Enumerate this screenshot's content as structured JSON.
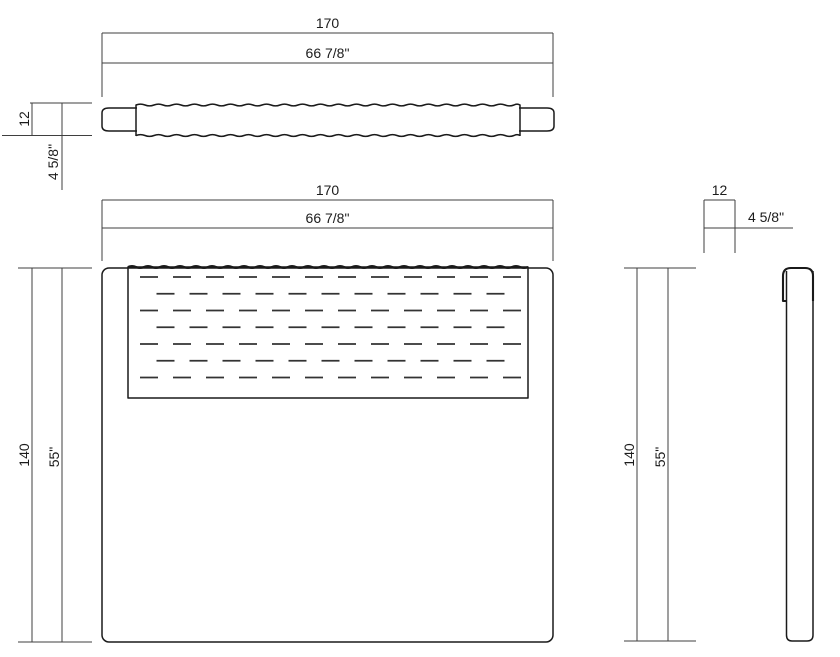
{
  "top_view": {
    "width_cm": "170",
    "width_in": "66 7/8\"",
    "thickness_cm": "12",
    "thickness_in": "4 5/8\""
  },
  "front_view": {
    "width_cm": "170",
    "width_in": "66 7/8\"",
    "height_cm": "140",
    "height_in": "55\""
  },
  "side_view": {
    "thickness_cm": "12",
    "thickness_in": "4 5/8\"",
    "height_cm": "140",
    "height_in": "55\""
  },
  "colors": {
    "line": "#1a1a1a",
    "dim_line": "#3f3f3f",
    "background": "#ffffff"
  }
}
